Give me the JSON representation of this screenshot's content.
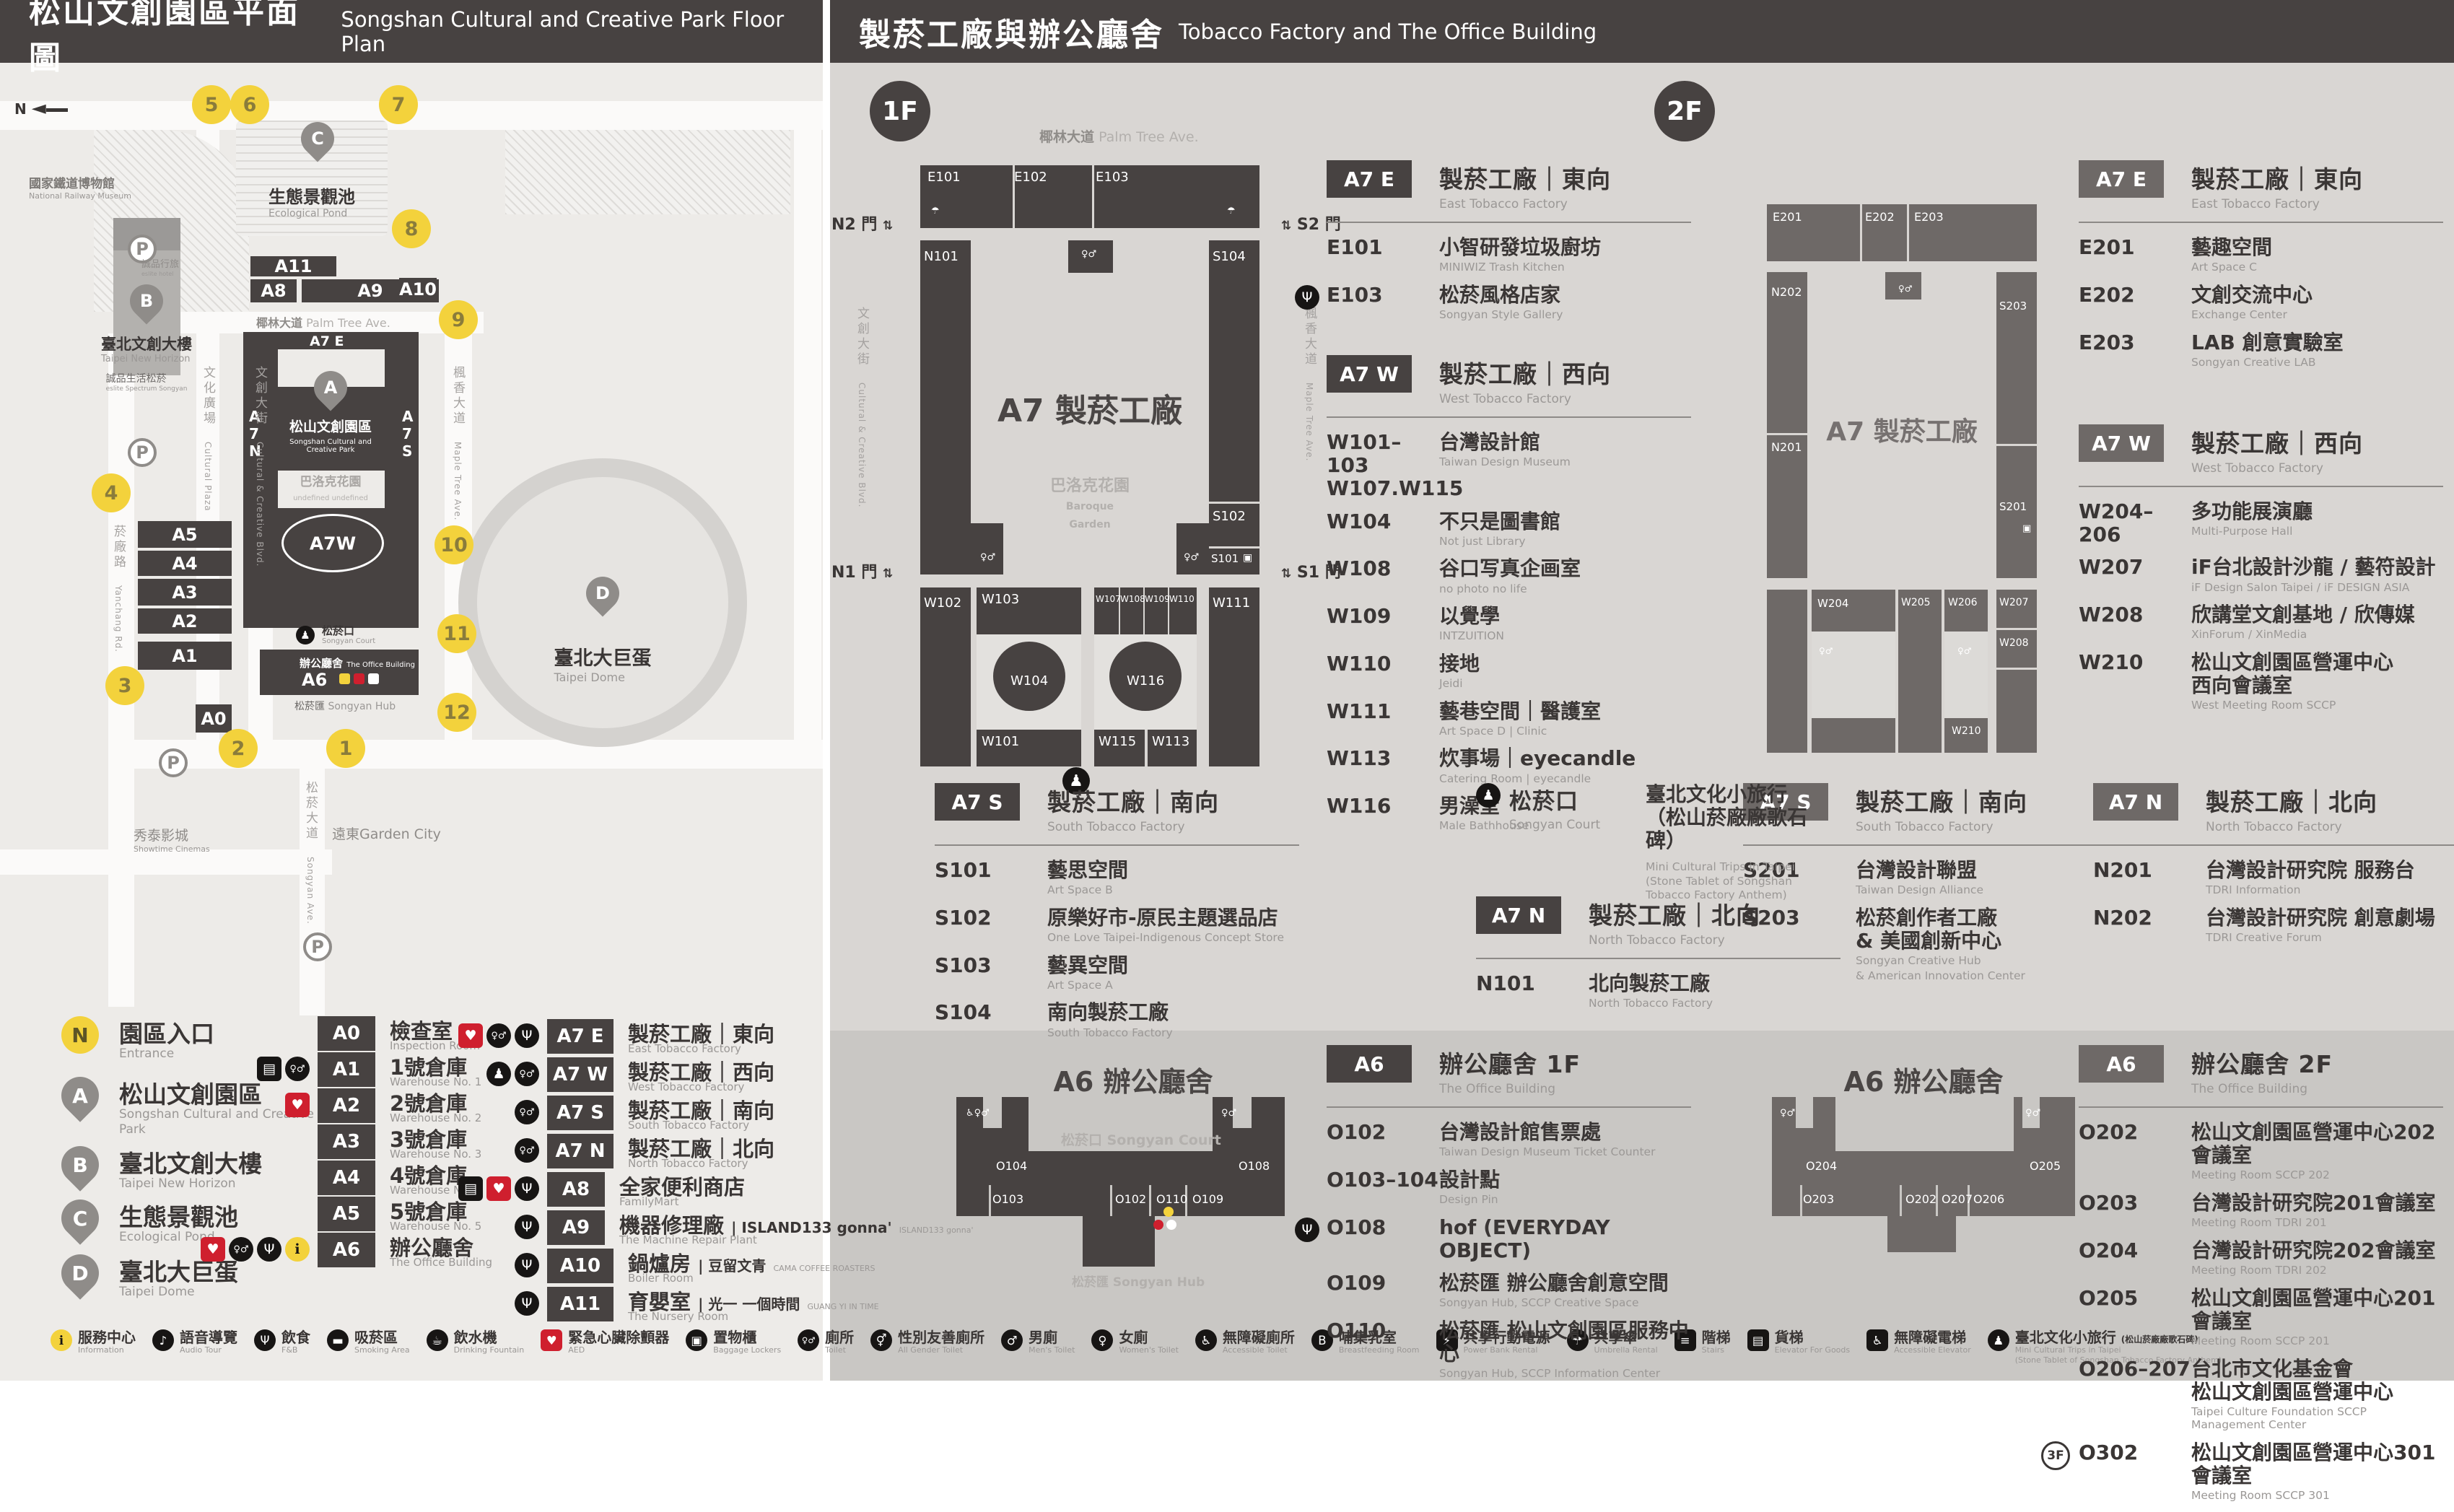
{
  "header_left": {
    "zh": "松山文創園區平面圖",
    "en": "Songshan Cultural and Creative Park Floor Plan"
  },
  "header_right": {
    "zh": "製菸工廠與辦公廳舍",
    "en": "Tobacco Factory and The Office Building"
  },
  "map": {
    "compass": "N",
    "parking": "P",
    "entrances": [
      "1",
      "2",
      "3",
      "4",
      "5",
      "6",
      "7",
      "8",
      "9",
      "10",
      "11",
      "12"
    ],
    "pins": {
      "A": "A",
      "B": "B",
      "C": "C",
      "D": "D"
    },
    "buildings": [
      "A0",
      "A1",
      "A2",
      "A3",
      "A4",
      "A5",
      "A8",
      "A9",
      "A10",
      "A11"
    ],
    "a7": {
      "e": "A7 E",
      "w": "A7W",
      "n": [
        "A",
        "7",
        "N"
      ],
      "s": [
        "A",
        "7",
        "S"
      ],
      "a6": "A6"
    },
    "labels": {
      "railway": {
        "zh": "國家鐵道博物館",
        "en": "National Railway Museum"
      },
      "eslite_hotel": {
        "zh": "誠品行旅",
        "en": "eslite hotel"
      },
      "new_horizon": {
        "zh": "臺北文創大樓",
        "en": "Taipei New Horizon"
      },
      "eslite_spectrum": {
        "zh": "誠品生活松菸",
        "en": "eslite Spectrum Songyan"
      },
      "pond": {
        "zh": "生態景觀池",
        "en": "Ecological Pond"
      },
      "dome": {
        "zh": "臺北大巨蛋",
        "en": "Taipei Dome"
      },
      "sccp": {
        "zh": "松山文創園區",
        "en1": "Songshan Cultural and",
        "en2": "Creative Park"
      },
      "baroque": {
        "zh": "巴洛克花園",
        "en": "Baroque Garden"
      },
      "court": {
        "zh": "松菸口",
        "en": "Songyan Court"
      },
      "office": {
        "zh": "辦公廳舍",
        "en": "The Office Building"
      },
      "hub": {
        "zh": "松菸匯",
        "en": "Songyan Hub"
      },
      "palm": {
        "zh": "椰林大道",
        "en": "Palm Tree Ave."
      },
      "maple": {
        "zh": "楓香大道",
        "en": "Maple Tree Ave."
      },
      "ccblvd": {
        "zh": "文創大街",
        "en": "Cultural & Creative Blvd."
      },
      "cplaza": {
        "zh": "文化廣場",
        "en": "Cultural Plaza"
      },
      "yanchang": {
        "zh": "菸廠路",
        "en": "Yanchang Rd."
      },
      "songyan_ave": {
        "zh": "松菸大道",
        "en": "Songyan Ave."
      },
      "showtime": {
        "zh": "秀泰影城",
        "en": "Showtime Cinemas"
      },
      "garden_city": {
        "zh": "遠東Garden City",
        "en": ""
      }
    }
  },
  "legend": {
    "places": [
      {
        "letter": "N",
        "zh": "園區入口",
        "en": "Entrance",
        "entrance": true
      },
      {
        "letter": "A",
        "zh": "松山文創園區",
        "en": "Songshan Cultural and Creative Park"
      },
      {
        "letter": "B",
        "zh": "臺北文創大樓",
        "en": "Taipei New Horizon"
      },
      {
        "letter": "C",
        "zh": "生態景觀池",
        "en": "Ecological Pond"
      },
      {
        "letter": "D",
        "zh": "臺北大巨蛋",
        "en": "Taipei Dome"
      }
    ],
    "col2": [
      {
        "code": "A0",
        "zh": "檢查室",
        "en": "Inspection Room",
        "icons": []
      },
      {
        "code": "A1",
        "zh": "1號倉庫",
        "en": "Warehouse No. 1",
        "icons": [
          "elev",
          "toilet"
        ]
      },
      {
        "code": "A2",
        "zh": "2號倉庫",
        "en": "Warehouse No. 2",
        "icons": [
          "aed"
        ]
      },
      {
        "code": "A3",
        "zh": "3號倉庫",
        "en": "Warehouse No. 3",
        "icons": []
      },
      {
        "code": "A4",
        "zh": "4號倉庫",
        "en": "Warehouse No. 4",
        "icons": []
      },
      {
        "code": "A5",
        "zh": "5號倉庫",
        "en": "Warehouse No. 5",
        "icons": []
      },
      {
        "code": "A6",
        "zh": "辦公廳舍",
        "en": "The Office Building",
        "icons": [
          "aed",
          "toilet",
          "fnb",
          "info"
        ]
      }
    ],
    "col3": [
      {
        "code": "A7 E",
        "zh": "製菸工廠｜東向",
        "en": "East Tobacco Factory",
        "icons": [
          "aed",
          "toilet",
          "fnb"
        ]
      },
      {
        "code": "A7 W",
        "zh": "製菸工廠｜西向",
        "en": "West Tobacco Factory",
        "icons": [
          "trip",
          "toilet"
        ]
      },
      {
        "code": "A7 S",
        "zh": "製菸工廠｜南向",
        "en": "South Tobacco Factory",
        "icons": [
          "toilet"
        ]
      },
      {
        "code": "A7 N",
        "zh": "製菸工廠｜北向",
        "en": "North Tobacco Factory",
        "icons": [
          "toilet"
        ]
      },
      {
        "code": "A8",
        "zh": "全家便利商店",
        "en": "FamilyMart",
        "icons": [
          "elev",
          "aed",
          "fnb"
        ]
      },
      {
        "code": "A9",
        "zh": "機器修理廠",
        "brand": "ISLAND133 gonna'",
        "brand_sub": "ISLAND133 gonna'",
        "en": "The Machine Repair Plant",
        "icons": [
          "fnb"
        ]
      },
      {
        "code": "A10",
        "zh": "鍋爐房",
        "brand": "豆留文青",
        "brand_sub": "CAMA COFFEE ROASTERS",
        "en": "Boiler Room",
        "icons": [
          "fnb"
        ]
      },
      {
        "code": "A11",
        "zh": "育嬰室",
        "brand": "光一 一個時間",
        "brand_sub": "GUANG YI IN TIME",
        "en": "The Nursery Room",
        "icons": [
          "fnb"
        ]
      }
    ]
  },
  "facilities": [
    {
      "id": "info",
      "zh": "服務中心",
      "en": "Information"
    },
    {
      "id": "audio",
      "zh": "語音導覽",
      "en": "Audio Tour"
    },
    {
      "id": "fnb",
      "zh": "飲食",
      "en": "F&B"
    },
    {
      "id": "smoking",
      "zh": "吸菸區",
      "en": "Smoking Area"
    },
    {
      "id": "fountain",
      "zh": "飲水機",
      "en": "Drinking Fountain"
    },
    {
      "id": "aed",
      "zh": "緊急心臟除顫器",
      "en": "AED"
    },
    {
      "id": "lockers",
      "zh": "置物櫃",
      "en": "Baggage Lockers"
    },
    {
      "id": "toilet",
      "zh": "廁所",
      "en": "Toilet"
    },
    {
      "id": "allgender",
      "zh": "性別友善廁所",
      "en": "All Gender Toilet"
    },
    {
      "id": "mens",
      "zh": "男廁",
      "en": "Men's Toilet"
    },
    {
      "id": "womens",
      "zh": "女廁",
      "en": "Women's Toilet"
    },
    {
      "id": "accessible",
      "zh": "無障礙廁所",
      "en": "Accessible Toilet"
    },
    {
      "id": "nursing",
      "zh": "哺集乳室",
      "en": "Breastfeeding Room"
    },
    {
      "id": "powerbank",
      "zh": "共享行動電源",
      "en": "Power Bank Rental"
    },
    {
      "id": "umbrella",
      "zh": "共享傘",
      "en": "Umbrella Rental"
    },
    {
      "id": "stairs",
      "zh": "階梯",
      "en": "Stairs"
    },
    {
      "id": "goods_elev",
      "zh": "貨梯",
      "en": "Elevator For Goods"
    },
    {
      "id": "acc_elev",
      "zh": "無障礙電梯",
      "en": "Accessible Elevator"
    },
    {
      "id": "trip",
      "zh": "臺北文化小旅行",
      "zh2": "(松山菸廠廠歌石碑)",
      "en": "Mini Cultural Trips in Taipei",
      "en2": "(Stone Tablet of Songshan Tobacco Factory Anthem)"
    }
  ],
  "floor1": {
    "badge": "1F",
    "plan": {
      "center": "A7 製菸工廠",
      "garden": {
        "zh": "巴洛克花園",
        "en1": "Baroque",
        "en2": "Garden"
      },
      "gates": {
        "n2": "N2 門",
        "s2": "S2 門",
        "n1": "N1 門",
        "s1": "S1 門"
      },
      "rooms": [
        "E101",
        "E102",
        "E103",
        "N101",
        "S104",
        "S102",
        "S101",
        "W102",
        "W103",
        "W107",
        "W108",
        "W109",
        "W110",
        "W111",
        "W104",
        "W116",
        "W101",
        "W115",
        "W113"
      ]
    },
    "sections": [
      {
        "id": "a7e-1f",
        "code": "A7 E",
        "zh": "製菸工廠｜東向",
        "en": "East Tobacco Factory",
        "items": [
          {
            "code": "E101",
            "zh": "小智研發垃圾廚坊",
            "en": "MINIWIZ Trash Kitchen"
          },
          {
            "code": "E103",
            "zh": "松菸風格店家",
            "en": "Songyan Style Gallery",
            "icon": "fnb"
          }
        ]
      },
      {
        "id": "a7w-1f",
        "code": "A7 W",
        "zh": "製菸工廠｜西向",
        "en": "West Tobacco Factory",
        "items": [
          {
            "code": "W101–103",
            "code2": "W107.W115",
            "zh": "台灣設計館",
            "en": "Taiwan Design Museum"
          },
          {
            "code": "W104",
            "zh": "不只是圖書館",
            "en": "Not just Library"
          },
          {
            "code": "W108",
            "zh": "谷口写真企画室",
            "en": "no photo no life"
          },
          {
            "code": "W109",
            "zh": "以覺學",
            "en": "INTZUITION"
          },
          {
            "code": "W110",
            "zh": "接地",
            "en": "Jeidi"
          },
          {
            "code": "W111",
            "zh": "藝巷空間｜醫護室",
            "en": "Art Space D | Clinic"
          },
          {
            "code": "W113",
            "zh": "炊事場｜eyecandle",
            "en": "Catering Room | eyecandle"
          },
          {
            "code": "W116",
            "zh": "男澡堂",
            "en": "Male Bathhouse"
          }
        ]
      },
      {
        "id": "a7s-1f",
        "code": "A7 S",
        "zh": "製菸工廠｜南向",
        "en": "South Tobacco Factory",
        "items": [
          {
            "code": "S101",
            "zh": "藝思空間",
            "en": "Art Space B"
          },
          {
            "code": "S102",
            "zh": "原樂好市-原民主題選品店",
            "en": "One Love Taipei-Indigenous Concept Store"
          },
          {
            "code": "S103",
            "zh": "藝異空間",
            "en": "Art Space A"
          },
          {
            "code": "S104",
            "zh": "南向製菸工廠",
            "en": "South Tobacco Factory"
          }
        ]
      },
      {
        "id": "a7n-1f",
        "code": "A7 N",
        "zh": "製菸工廠｜北向",
        "en": "North Tobacco Factory",
        "items": [
          {
            "code": "N101",
            "zh": "北向製菸工廠",
            "en": "North Tobacco Factory"
          }
        ]
      }
    ],
    "court": {
      "zh": "松菸口",
      "en": "Songyan Court",
      "item": {
        "zh": "臺北文化小旅行",
        "zh2": "（松山菸廠廠歌石碑）",
        "en": "Mini Cultural Trips in Taipei",
        "en2": "(Stone Tablet of Songshan Tobacco Factory Anthem)"
      }
    },
    "a6": {
      "code": "A6",
      "zh": "辦公廳舍 1F",
      "en": "The Office Building",
      "items": [
        {
          "code": "O102",
          "zh": "台灣設計館售票處",
          "en": "Taiwan Design Museum Ticket Counter"
        },
        {
          "code": "O103–104",
          "zh": "設計點",
          "en": "Design Pin"
        },
        {
          "code": "O108",
          "zh": "hof (EVERYDAY OBJECT)",
          "en": "",
          "icon": "fnb"
        },
        {
          "code": "O109",
          "zh": "松菸匯 辦公廳舍創意空間",
          "en": "Songyan Hub, SCCP Creative Space"
        },
        {
          "code": "O110",
          "zh": "松菸匯 松山文創園區服務中心",
          "en": "Songyan Hub, SCCP Information Center"
        }
      ],
      "plan": {
        "title": "A6 辦公廳舍",
        "court": "松菸口 Songyan Court",
        "hub": "松菸匯 Songyan Hub",
        "rooms": [
          "O104",
          "O103",
          "O102",
          "O110",
          "O109",
          "O108"
        ]
      }
    }
  },
  "floor2": {
    "badge": "2F",
    "plan": {
      "center": "A7 製菸工廠",
      "rooms": [
        "E201",
        "E202",
        "E203",
        "N202",
        "N201",
        "S203",
        "S201",
        "W204",
        "W205",
        "W206",
        "W207",
        "W208",
        "W210"
      ]
    },
    "sections": [
      {
        "id": "a7e-2f",
        "code": "A7 E",
        "zh": "製菸工廠｜東向",
        "en": "East Tobacco Factory",
        "items": [
          {
            "code": "E201",
            "zh": "藝趣空間",
            "en": "Art Space C"
          },
          {
            "code": "E202",
            "zh": "文創交流中心",
            "en": "Exchange Center"
          },
          {
            "code": "E203",
            "zh": "LAB 創意實驗室",
            "en": "Songyan Creative LAB"
          }
        ]
      },
      {
        "id": "a7w-2f",
        "code": "A7 W",
        "zh": "製菸工廠｜西向",
        "en": "West Tobacco Factory",
        "items": [
          {
            "code": "W204–206",
            "zh": "多功能展演廳",
            "en": "Multi-Purpose Hall"
          },
          {
            "code": "W207",
            "zh": "iF台北設計沙龍 / 藝符設計",
            "en": "iF Design Salon Taipei / iF DESIGN ASIA"
          },
          {
            "code": "W208",
            "zh": "欣講堂文創基地 / 欣傳媒",
            "en": "XinForum / XinMedia"
          },
          {
            "code": "W210",
            "zh": "松山文創園區營運中心",
            "zh2": "西向會議室",
            "en": "West Meeting Room SCCP"
          }
        ]
      },
      {
        "id": "a7s-2f",
        "code": "A7 S",
        "zh": "製菸工廠｜南向",
        "en": "South Tobacco Factory",
        "items": [
          {
            "code": "S201",
            "zh": "台灣設計聯盟",
            "en": "Taiwan Design Alliance"
          },
          {
            "code": "S203",
            "zh": "松菸創作者工廠",
            "zh2": "& 美國創新中心",
            "en": "Songyan Creative Hub",
            "en2": "& American Innovation Center"
          }
        ]
      },
      {
        "id": "a7n-2f",
        "code": "A7 N",
        "zh": "製菸工廠｜北向",
        "en": "North Tobacco Factory",
        "items": [
          {
            "code": "N201",
            "zh": "台灣設計研究院 服務台",
            "en": "TDRI Information"
          },
          {
            "code": "N202",
            "zh": "台灣設計研究院 創意劇場",
            "en": "TDRI Creative Forum"
          }
        ]
      }
    ],
    "a6": {
      "code": "A6",
      "zh": "辦公廳舍 2F",
      "en": "The Office Building",
      "items": [
        {
          "code": "O202",
          "zh": "松山文創園區營運中心202會議室",
          "en": "Meeting Room SCCP 202"
        },
        {
          "code": "O203",
          "zh": "台灣設計研究院201會議室",
          "en": "Meeting Room TDRI 201"
        },
        {
          "code": "O204",
          "zh": "台灣設計研究院202會議室",
          "en": "Meeting Room TDRI 202"
        },
        {
          "code": "O205",
          "zh": "松山文創園區營運中心201會議室",
          "en": "Meeting Room SCCP 201"
        },
        {
          "code": "O206–207",
          "zh": "台北市文化基金會",
          "zh2": "松山文創園區營運中心",
          "en": "Taipei Culture Foundation SCCP Management Center"
        },
        {
          "code": "O302",
          "zh": "松山文創園區營運中心301會議室",
          "en": "Meeting Room SCCP 301",
          "badge": "3F"
        }
      ],
      "plan": {
        "title": "A6 辦公廳舍",
        "rooms": [
          "O204",
          "O203",
          "O202",
          "O207",
          "O206",
          "O205"
        ]
      }
    }
  }
}
